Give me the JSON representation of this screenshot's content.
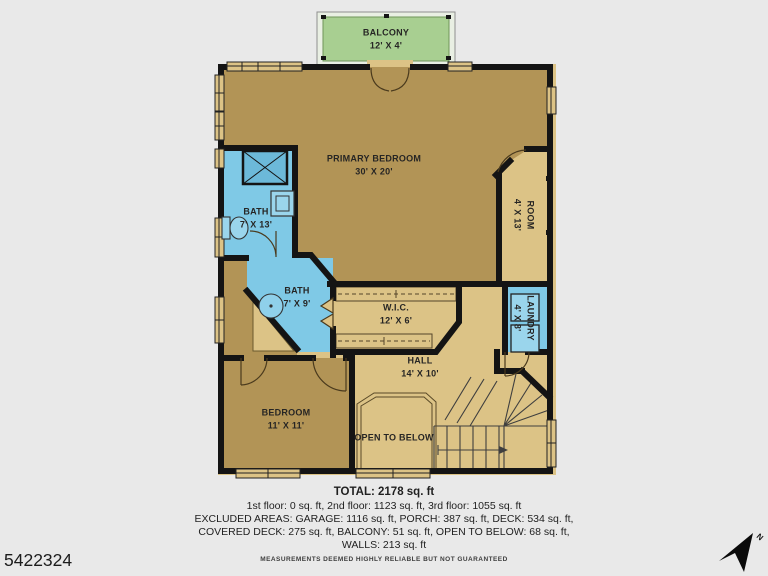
{
  "page": {
    "photo_id": "5422324",
    "disclaimer": "MEASUREMENTS DEEMED HIGHLY RELIABLE BUT NOT GUARANTEED",
    "compass_label": "N"
  },
  "rooms": {
    "balcony": {
      "name": "BALCONY",
      "dims": "12' X 4'"
    },
    "primary_bedroom": {
      "name": "PRIMARY BEDROOM",
      "dims": "30' X 20'"
    },
    "room": {
      "name": "ROOM",
      "dims": "4' X 13'"
    },
    "bath_large": {
      "name": "BATH",
      "dims": "7' X 13'"
    },
    "bath_small": {
      "name": "BATH",
      "dims": "7' X 9'"
    },
    "wic": {
      "name": "W.I.C.",
      "dims": "12' X 6'"
    },
    "laundry": {
      "name": "LAUNDRY",
      "dims": "4' X 8'"
    },
    "hall": {
      "name": "HALL",
      "dims": "14' X 10'"
    },
    "bedroom": {
      "name": "BEDROOM",
      "dims": "11' X 11'"
    },
    "open_to_below": {
      "name": "OPEN TO BELOW"
    }
  },
  "summary": {
    "total": "TOTAL: 2178 sq. ft",
    "line1": "1st floor: 0 sq. ft, 2nd floor: 1123 sq. ft, 3rd floor: 1055 sq. ft",
    "line2": "EXCLUDED AREAS: GARAGE: 1116 sq. ft, PORCH: 387 sq. ft, DECK: 534 sq. ft,",
    "line3": "COVERED DECK: 275 sq. ft, BALCONY: 51 sq. ft, OPEN TO BELOW: 68 sq. ft,",
    "line4": "WALLS: 213 sq. ft"
  },
  "colors": {
    "background": "#e9e9e9",
    "walls": "#141414",
    "room_dark_tan": "#b29456",
    "room_light_tan": "#dcc386",
    "wet_room_blue": "#7fc9e6",
    "balcony_green": "#a8cf91"
  }
}
